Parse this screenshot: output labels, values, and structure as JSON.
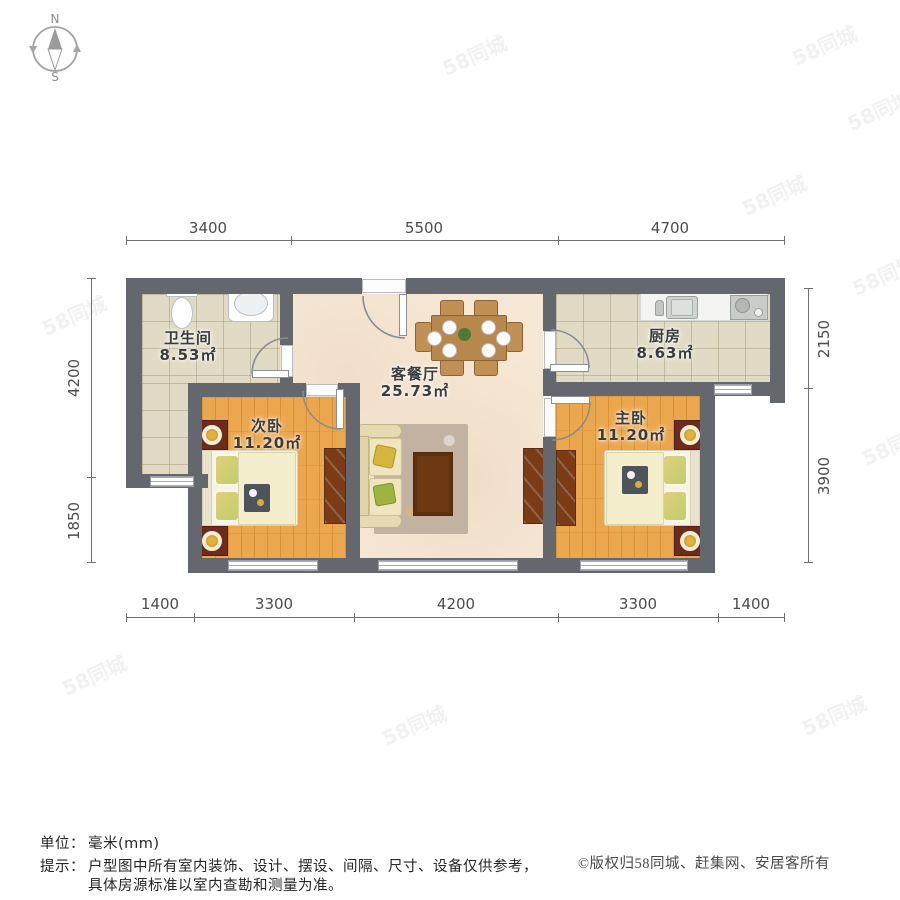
{
  "compass": {
    "north": "N",
    "south": "S"
  },
  "dimensions": {
    "top": [
      "3400",
      "5500",
      "4700"
    ],
    "bottom": [
      "1400",
      "3300",
      "4200",
      "3300",
      "1400"
    ],
    "left": [
      "4200",
      "1850"
    ],
    "right": [
      "2150",
      "3900"
    ]
  },
  "rooms": {
    "bathroom": {
      "name": "卫生间",
      "area": "8.53㎡"
    },
    "living": {
      "name": "客餐厅",
      "area": "25.73㎡"
    },
    "kitchen": {
      "name": "厨房",
      "area": "8.63㎡"
    },
    "secondary_bedroom": {
      "name": "次卧",
      "area": "11.20㎡"
    },
    "master_bedroom": {
      "name": "主卧",
      "area": "11.20㎡"
    }
  },
  "footer": {
    "unit_label": "单位：",
    "unit_value": "毫米(mm)",
    "tip_label": "提示：",
    "tip_line1": "户型图中所有室内装饰、设计、摆设、间隔、尺寸、设备仅供参考，",
    "tip_line2": "具体房源标准以室内查勘和测量为准。",
    "copyright": "©版权归58同城、赶集网、安居客所有"
  },
  "watermark": {
    "text": "58同城"
  },
  "colors": {
    "wall": "#64686e",
    "wood_floor": "#eba74e",
    "tile_floor": "#e1dbc5",
    "living_floor": "#f6e8d5",
    "furniture_brown": "#7b3b14",
    "lamp_gold": "#c9992b",
    "dim_text": "#4c4c4c"
  }
}
